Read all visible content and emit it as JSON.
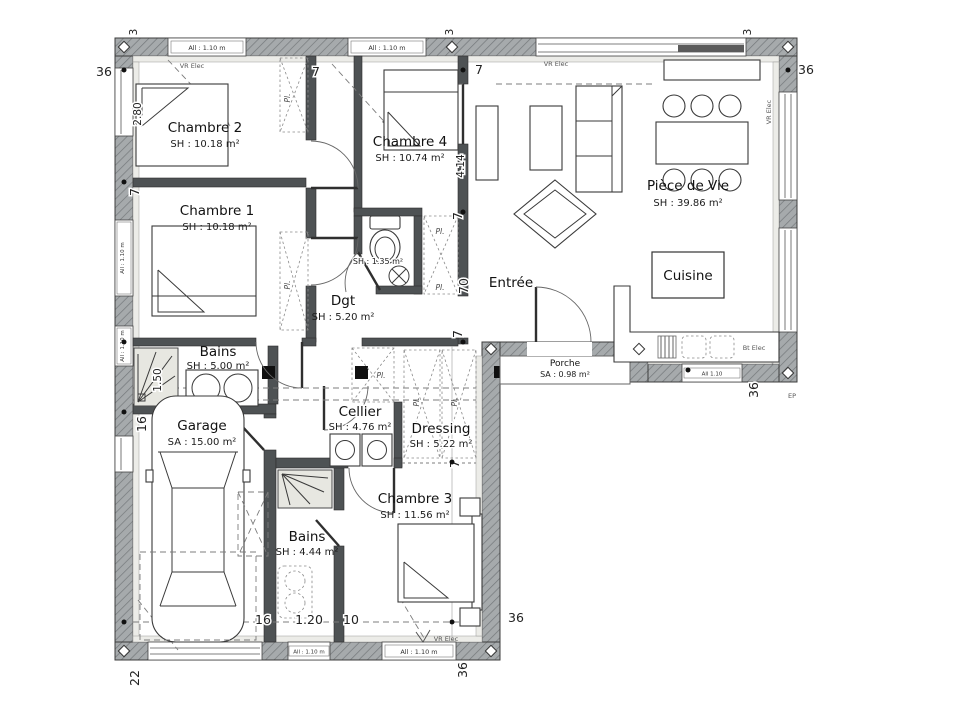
{
  "rooms": [
    {
      "name": "Chambre 2",
      "area": "SH : 10.18 m²"
    },
    {
      "name": "Chambre 1",
      "area": "SH : 10.18 m²"
    },
    {
      "name": "Chambre 4",
      "area": "SH : 10.74 m²"
    },
    {
      "name": "Pièce de Vie",
      "area": "SH : 39.86 m²"
    },
    {
      "name": "Cuisine",
      "area": ""
    },
    {
      "name": "Entrée",
      "area": ""
    },
    {
      "name": "Dgt",
      "area": "SH : 5.20 m²"
    },
    {
      "area": "SH : 1.35 m²"
    },
    {
      "name": "Bains",
      "area": "SH : 5.00 m²"
    },
    {
      "name": "Cellier",
      "area": "SH : 4.76 m²"
    },
    {
      "name": "Dressing",
      "area": "SH : 5.22 m²"
    },
    {
      "name": "Garage",
      "area": "SA : 15.00 m²"
    },
    {
      "name": "Bains",
      "area": "SH : 4.44 m²"
    },
    {
      "name": "Chambre 3",
      "area": "SH : 11.56 m²"
    },
    {
      "name": "Porche",
      "area": "SA : 0.98 m²"
    }
  ],
  "dims": {
    "d36": "36",
    "d7": "7",
    "d70": "70",
    "d16": "16",
    "d22": "22",
    "d10": "10",
    "d3": "3",
    "d280": "2.80",
    "d414": "4.14",
    "d150": "1.50",
    "d120": "1.20"
  },
  "ann": {
    "vr_elec": "VR Elec",
    "bt_elec": "Bt Elec",
    "ep": "EP",
    "pl": "Pl.",
    "all_110": "All : 1.10 m",
    "all_110_short": "All 1.10"
  }
}
